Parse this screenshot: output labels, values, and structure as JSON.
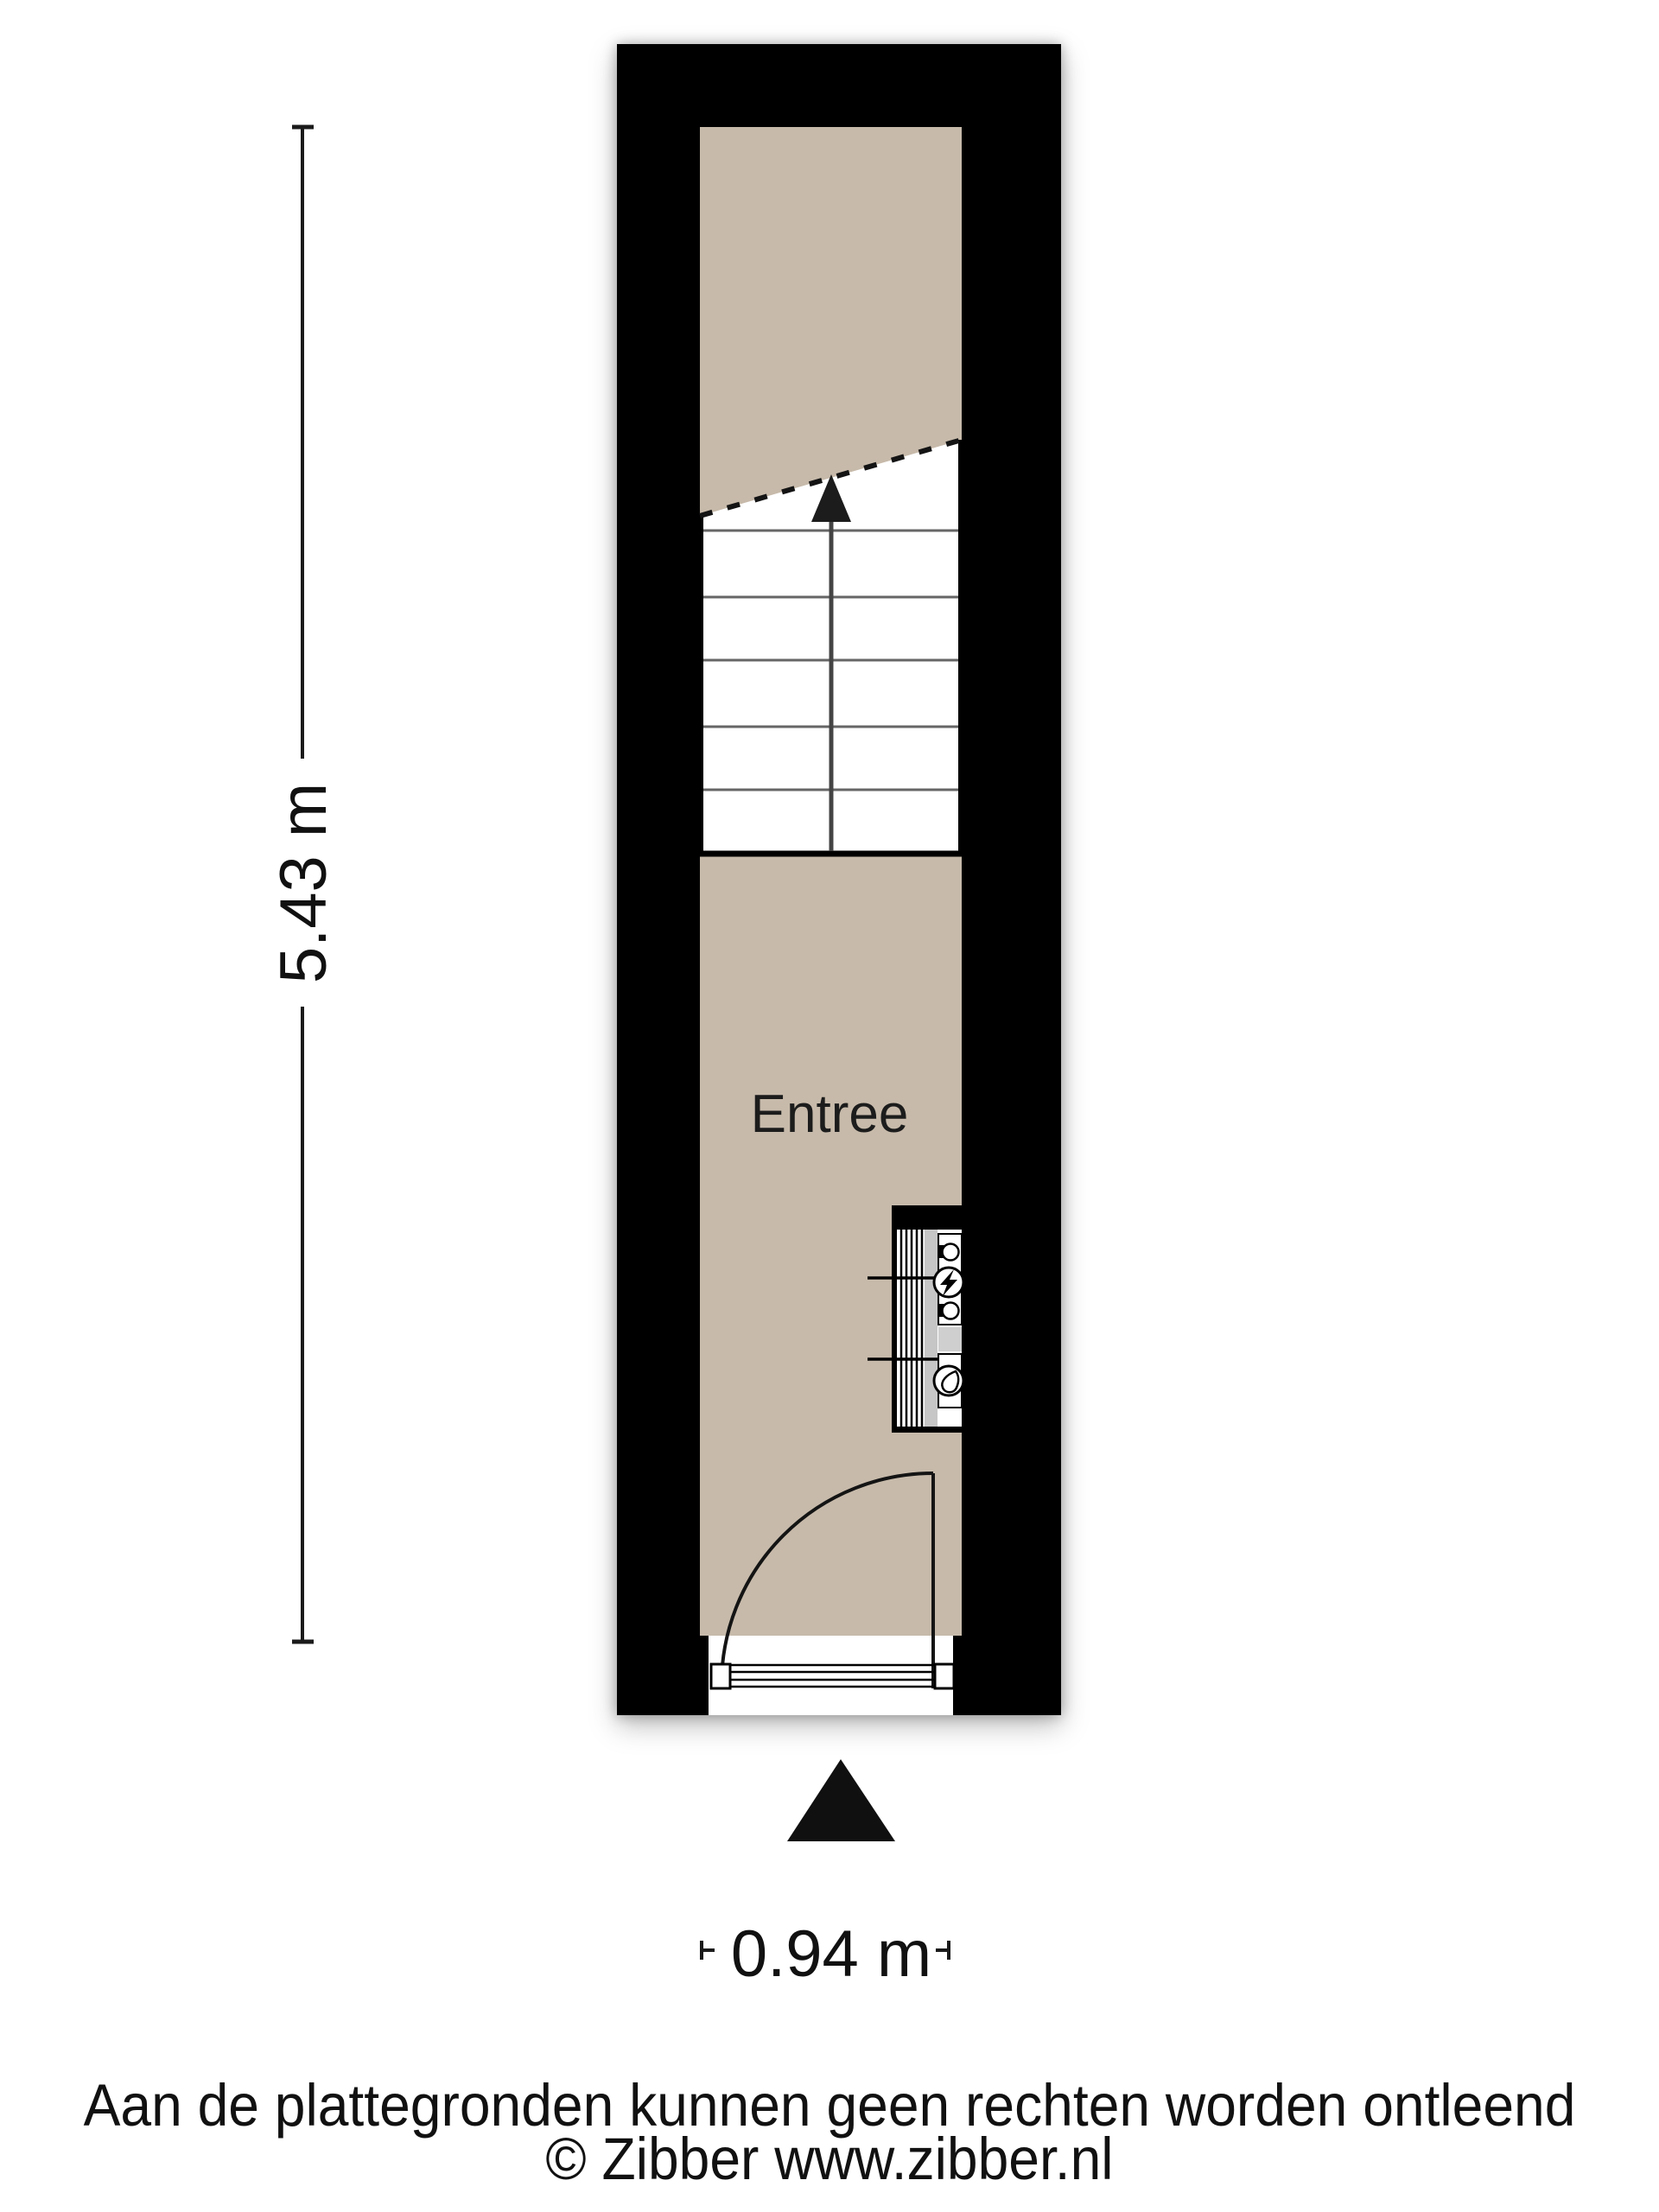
{
  "floorplan": {
    "room_label": "Entree",
    "stairs": {
      "direction_icon": "arrow-up",
      "step_count": 5,
      "break_line_style": "dashed"
    },
    "meter_cupboard": {
      "electricity_icon": "lightning-bolt",
      "water_icon": "water-droplet"
    },
    "entrance_icon": "triangle-up",
    "colors": {
      "wall": "#000000",
      "floor": "#c7baaa",
      "stair_fill": "#ffffff",
      "cupboard_gray": "#c6c6c6",
      "line": "#1a1a1a"
    }
  },
  "dimensions": {
    "height": "5.43 m",
    "width": "0.94 m"
  },
  "footer": {
    "disclaimer": "Aan de plattegronden kunnen geen rechten worden ontleend",
    "copyright": "© Zibber www.zibber.nl"
  }
}
